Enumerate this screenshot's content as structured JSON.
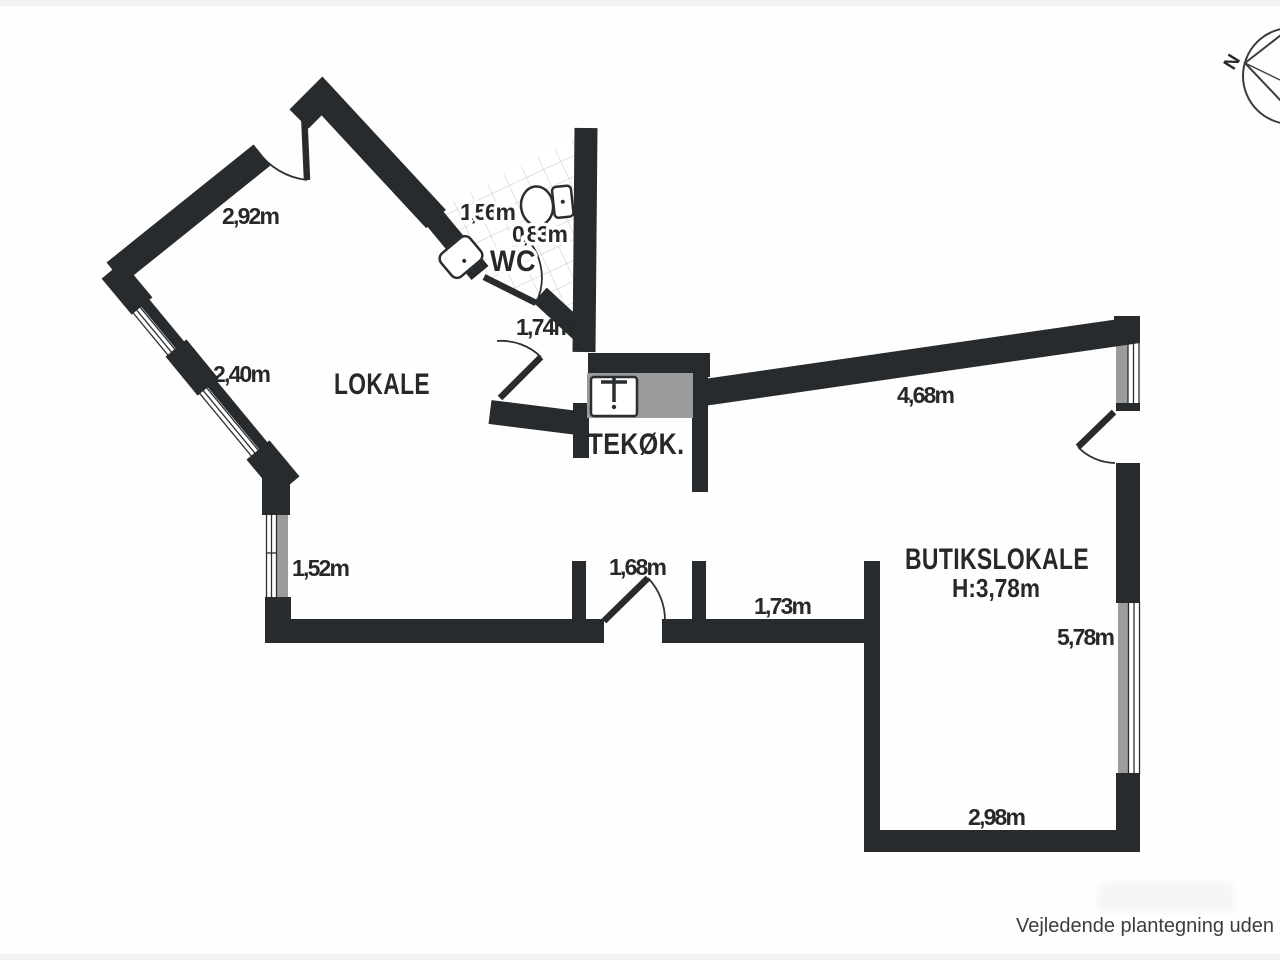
{
  "plan": {
    "rooms": {
      "lokale": "LOKALE",
      "wc": "WC",
      "tekoek": "TEKØK.",
      "butikslokale": "BUTIKSLOKALE",
      "butikslokale_height": "H:3,78m"
    },
    "measurements": {
      "top_left_wall": "2,92m",
      "left_window_upper": "2,40m",
      "left_window_lower": "1,52m",
      "wc_width": "1,56m",
      "wc_depth": "0,83m",
      "hallway": "1,74m",
      "diagonal_wall": "4,68m",
      "lokale_door": "1,68m",
      "passage": "1,73m",
      "right_window": "5,78m",
      "bottom_wall": "2,98m"
    },
    "compass": {
      "north": "N"
    }
  },
  "footer": {
    "disclaimer": "Vejledende plantegning uden a"
  },
  "colors": {
    "wall": "#282b2d",
    "window_gray": "#9c9c9c",
    "counter_gray": "#9b9b9b",
    "tile_line": "#cfcfcf",
    "text": "#26282a"
  }
}
